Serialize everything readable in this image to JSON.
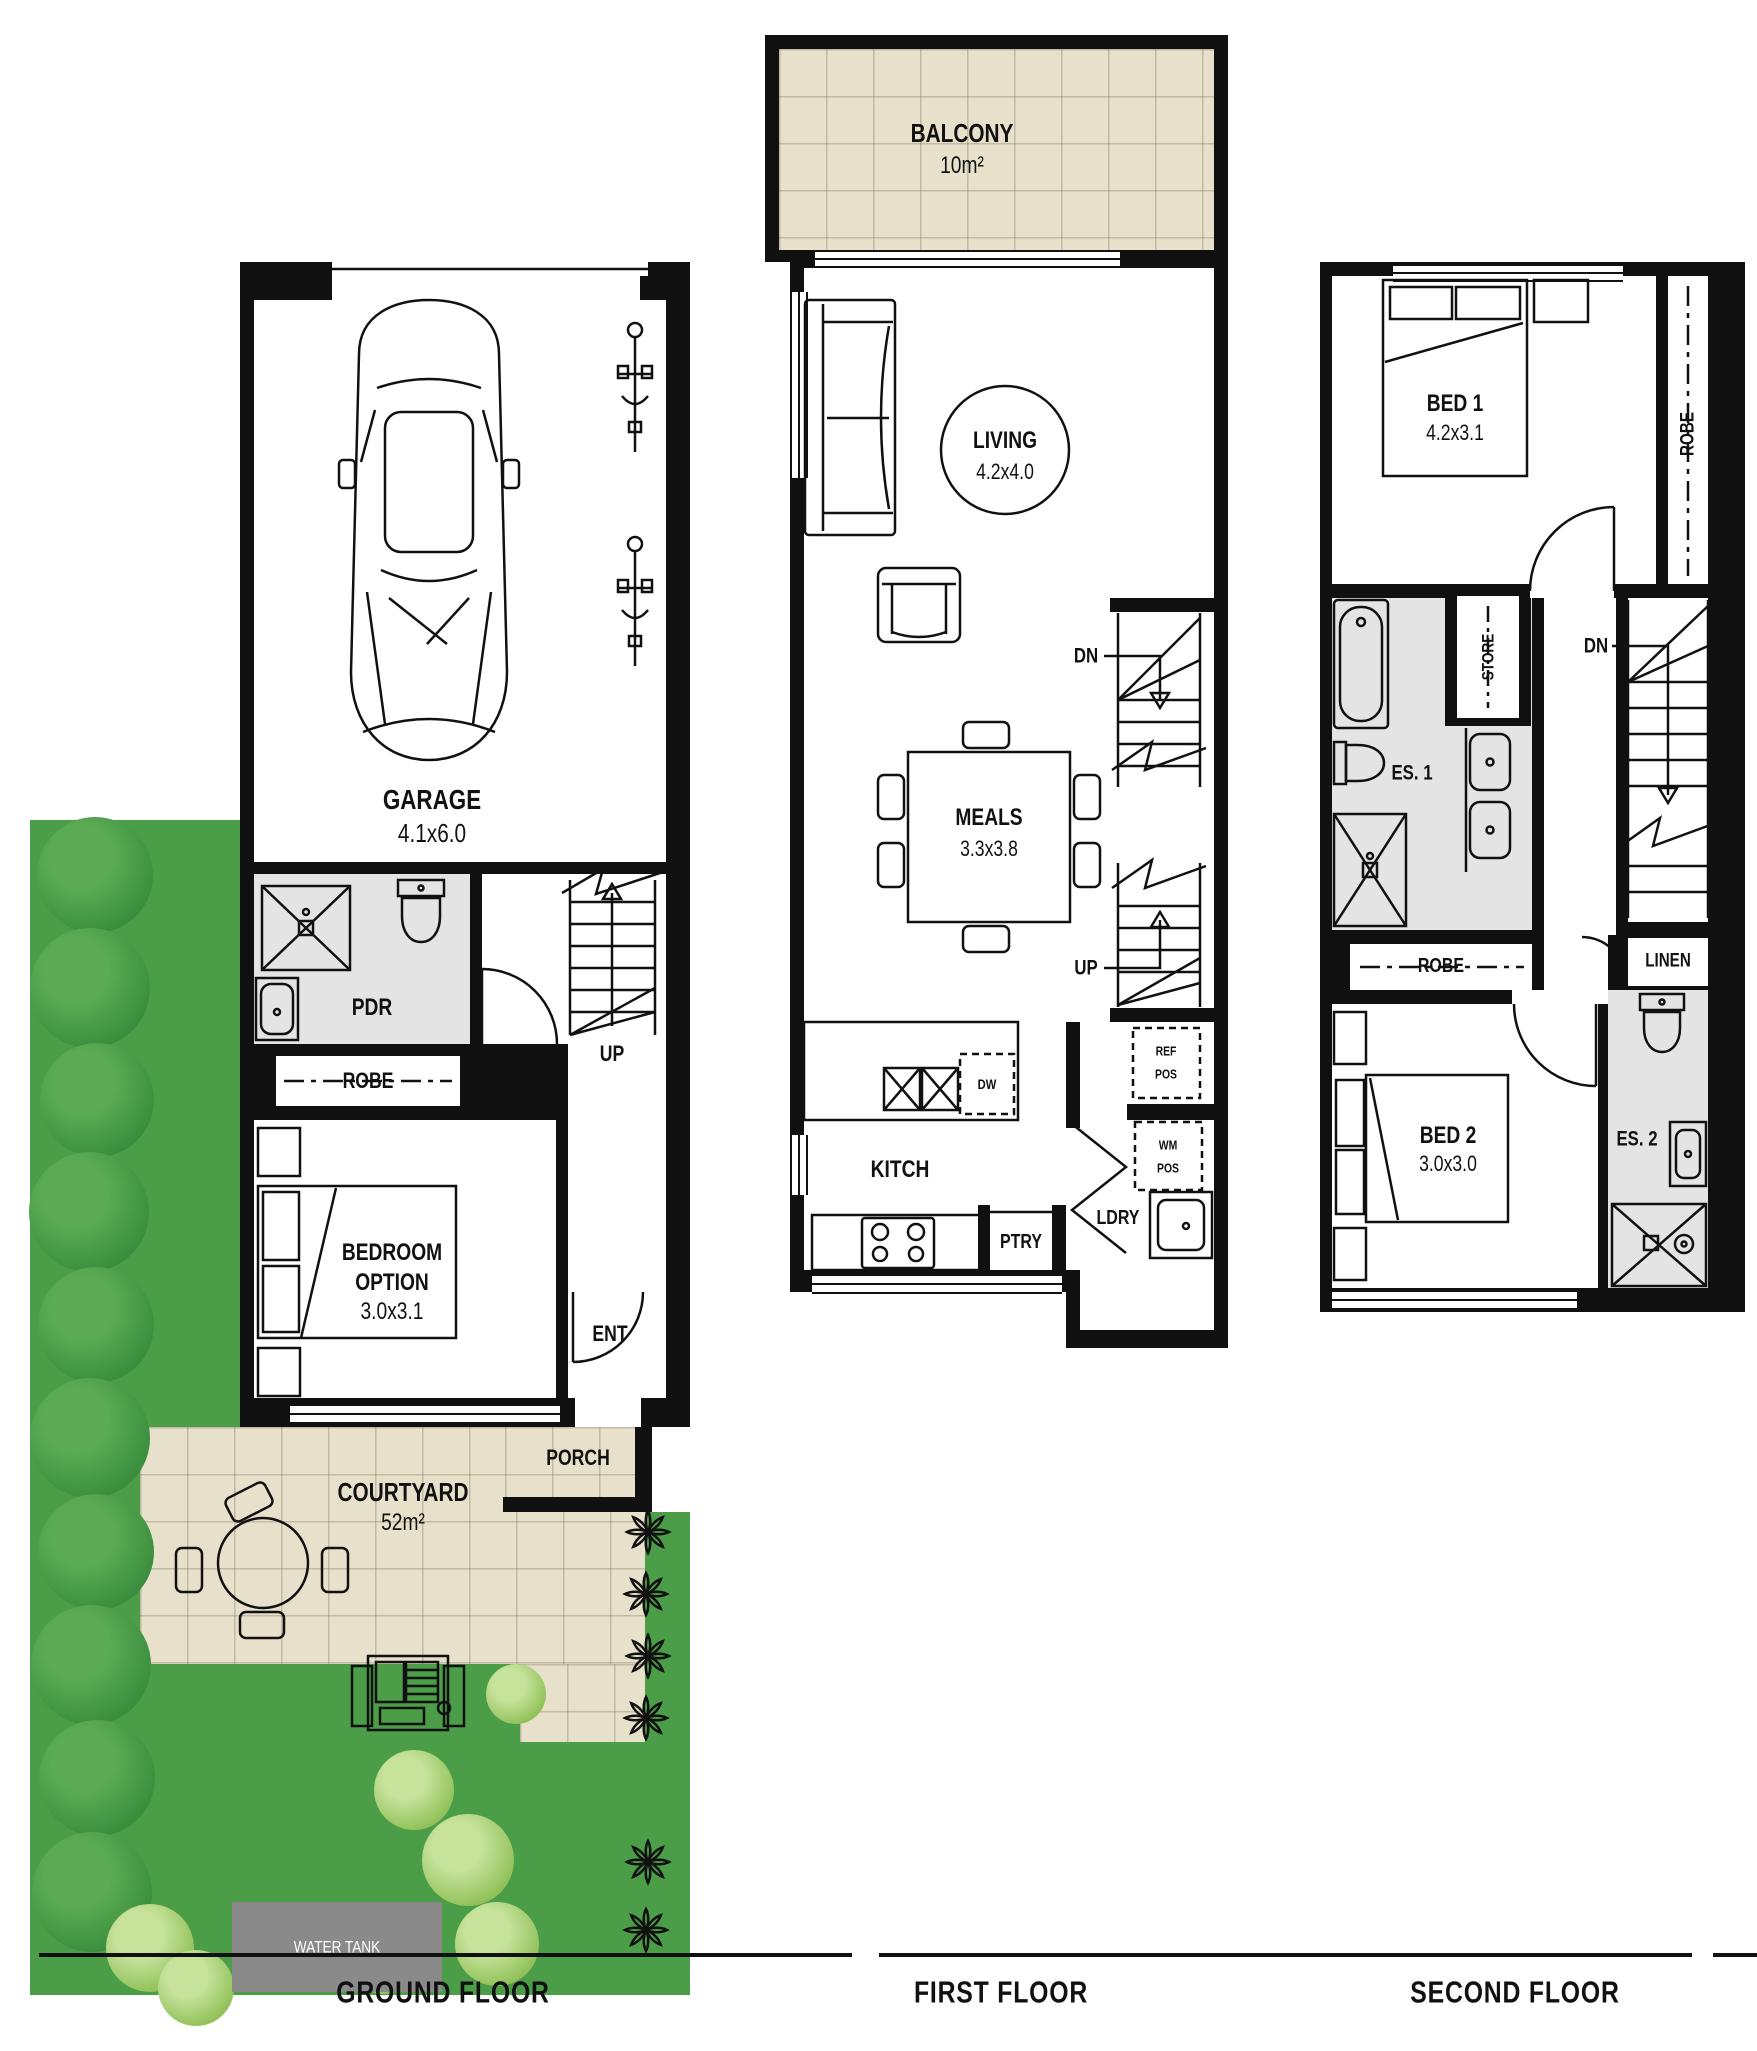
{
  "ground": {
    "floor_label": "GROUND FLOOR",
    "garage": {
      "name": "GARAGE",
      "dims": "4.1x6.0"
    },
    "pdr": "PDR",
    "robe": "ROBE",
    "up": "UP",
    "bedroom": {
      "line1": "BEDROOM",
      "line2": "OPTION",
      "dims": "3.0x3.1"
    },
    "ent": "ENT",
    "porch": "PORCH",
    "courtyard": {
      "name": "COURTYARD",
      "area": "52m²"
    },
    "water_tank": "WATER TANK"
  },
  "first": {
    "floor_label": "FIRST FLOOR",
    "balcony": {
      "name": "BALCONY",
      "area": "10m²"
    },
    "living": {
      "name": "LIVING",
      "dims": "4.2x4.0"
    },
    "meals": {
      "name": "MEALS",
      "dims": "3.3x3.8"
    },
    "dn": "DN",
    "up": "UP",
    "kitch": "KITCH",
    "dw": "DW",
    "ptry": "PTRY",
    "ldry": "LDRY",
    "ref": {
      "line1": "REF",
      "line2": "POS"
    },
    "wm": {
      "line1": "WM",
      "line2": "POS"
    }
  },
  "second": {
    "floor_label": "SECOND FLOOR",
    "bed1": {
      "name": "BED 1",
      "dims": "4.2x3.1"
    },
    "robe_side": "ROBE",
    "store": "STORE",
    "dn": "DN",
    "es1": "ES. 1",
    "robe": "ROBE",
    "linen": "LINEN",
    "bed2": {
      "name": "BED 2",
      "dims": "3.0x3.0"
    },
    "es2": "ES. 2"
  }
}
